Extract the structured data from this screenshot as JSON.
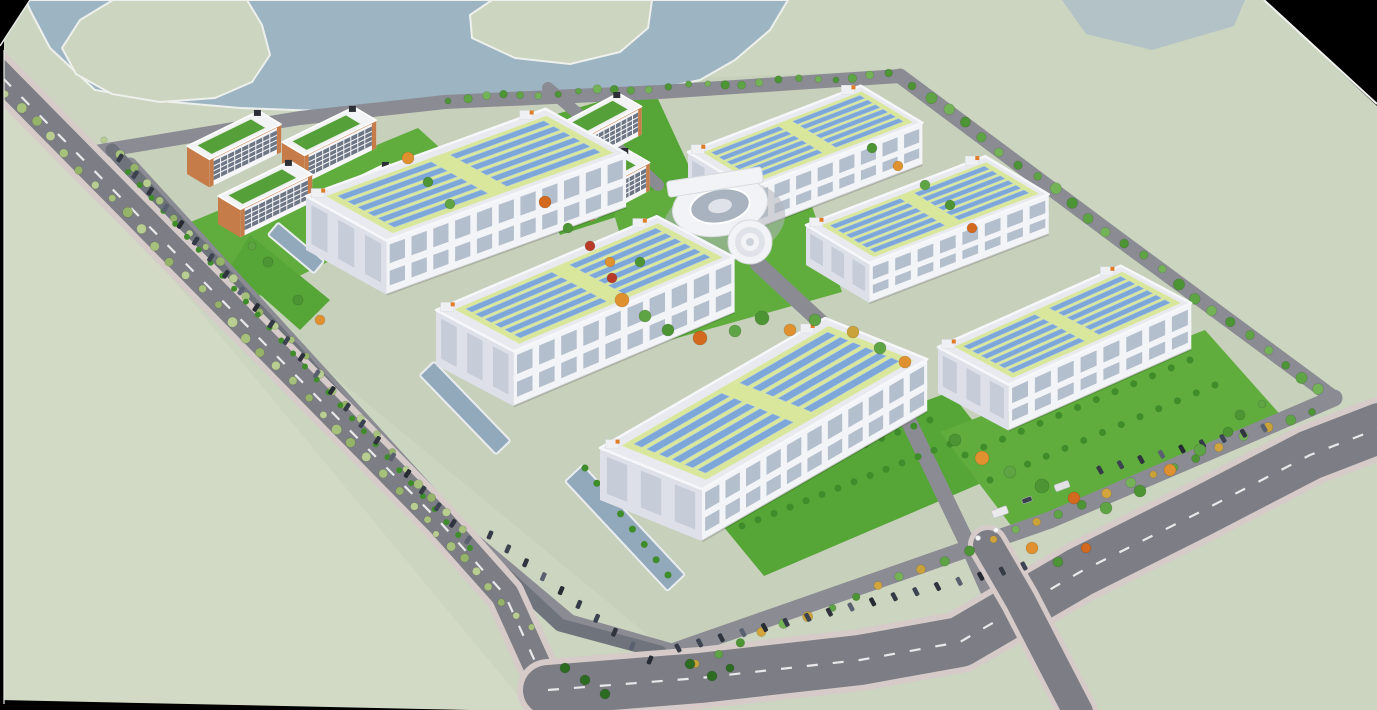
{
  "meta": {
    "description": "Aerial 3D architectural rendering of an industrial campus with solar-roof factory halls, office blocks, a circular admin building, lakes, tree-lined roads and parking",
    "width": 1377,
    "height": 710
  },
  "palette": {
    "void": "#000000",
    "terrain": "#cbd5c0",
    "lowland": "#d2dac6",
    "campus": "#c6d0ba",
    "water": "#9db4c2",
    "waterPocket": "#afc0c6",
    "shoreLine": "#edf0ec",
    "roadOuter": "#7d7d85",
    "roadInner": "#8b8b93",
    "sidewalk": "#d6cbc9",
    "dash": "#e9e9ec",
    "parking": "#6e737c",
    "lawn1": "#60ad3d",
    "lawn2": "#56a537",
    "hedge": "#3f8c2a",
    "pond": "#92a9bb",
    "pondRim": "#e9edf0",
    "factoryFront": "#f3f4f7",
    "factorySide": "#dde0e8",
    "factoryRoof": "#e8eaef",
    "roofRim": "#f6f7fa",
    "roofLime": "#d9e79c",
    "solarPanel": "#7da7d9",
    "solarRim": "#adc8e8",
    "windowBand": "#b4bfcd",
    "vent": "#eef0f3",
    "accentOrange": "#e07b28",
    "officeWall": "#f6f6f8",
    "officeTrim": "#c67c49",
    "officeWindow": "#6d7684",
    "officeRoof": "#f2f3f5",
    "officeRoofGreen": "#55a039",
    "darkUnit": "#2c3036",
    "circWhite": "#f2f3f6",
    "circMid": "#dfe3e9",
    "circCourt": "#a9b3bf",
    "circLine": "#d6dade",
    "plaza": "#b2b7be",
    "treePale": [
      "#b7cd92",
      "#a6c17c",
      "#95b469"
    ],
    "treeGreen": [
      "#4c9434",
      "#5ea344",
      "#74b258"
    ],
    "treeMixGold": [
      "#4c9434",
      "#5ea344",
      "#c9a23a",
      "#74b258",
      "#d2a43c"
    ],
    "clusterColors": {
      "or": "#e0912f",
      "o2": "#d2691e",
      "rd": "#b83a28",
      "gd": "#c9a23a",
      "g1": "#4c9434",
      "g2": "#5ea344",
      "g3": "#3b7f2b",
      "pn": "#2e6b22"
    },
    "carColors": [
      "#343b47",
      "#3d4451",
      "#2f343e",
      "#596070",
      "#272b33"
    ]
  },
  "terrain": {
    "lowlandPoly": [
      [
        0,
        70
      ],
      [
        530,
        710
      ],
      [
        0,
        710
      ]
    ],
    "campusPoly": [
      [
        70,
        158
      ],
      [
        440,
        88
      ],
      [
        900,
        70
      ],
      [
        1335,
        398
      ],
      [
        672,
        655
      ]
    ]
  },
  "water": {
    "main": [
      [
        26,
        0
      ],
      [
        788,
        0
      ],
      [
        770,
        30
      ],
      [
        735,
        60
      ],
      [
        700,
        80
      ],
      [
        662,
        88
      ],
      [
        560,
        93
      ],
      [
        445,
        97
      ],
      [
        390,
        104
      ],
      [
        320,
        111
      ],
      [
        240,
        108
      ],
      [
        160,
        101
      ],
      [
        95,
        90
      ],
      [
        50,
        48
      ],
      [
        30,
        10
      ]
    ],
    "islands": [
      [
        [
          113,
          0
        ],
        [
          247,
          0
        ],
        [
          262,
          25
        ],
        [
          270,
          55
        ],
        [
          252,
          82
        ],
        [
          215,
          98
        ],
        [
          160,
          102
        ],
        [
          112,
          94
        ],
        [
          76,
          74
        ],
        [
          62,
          48
        ],
        [
          80,
          20
        ]
      ],
      [
        [
          492,
          0
        ],
        [
          652,
          0
        ],
        [
          648,
          28
        ],
        [
          620,
          52
        ],
        [
          570,
          64
        ],
        [
          515,
          58
        ],
        [
          472,
          38
        ],
        [
          470,
          15
        ]
      ]
    ],
    "pocket": [
      [
        1062,
        0
      ],
      [
        1245,
        0
      ],
      [
        1234,
        26
      ],
      [
        1152,
        50
      ],
      [
        1086,
        34
      ]
    ]
  },
  "roads": {
    "outerLeft": {
      "pts": [
        [
          -15,
          60
        ],
        [
          200,
          278
        ],
        [
          440,
          522
        ],
        [
          505,
          595
        ],
        [
          548,
          690
        ]
      ],
      "w": 28,
      "sidewalk": 40,
      "dash": true
    },
    "bottom": {
      "pts": [
        [
          548,
          690
        ],
        [
          700,
          678
        ],
        [
          860,
          660
        ],
        [
          960,
          642
        ],
        [
          1080,
          572
        ],
        [
          1200,
          512
        ],
        [
          1310,
          455
        ],
        [
          1380,
          428
        ]
      ],
      "w": 50,
      "sidewalk": 62,
      "dash": true
    },
    "branch": {
      "pts": [
        [
          988,
          545
        ],
        [
          1020,
          600
        ],
        [
          1052,
          662
        ],
        [
          1078,
          712
        ]
      ],
      "w": 30,
      "sidewalk": 40,
      "dash": false
    },
    "internal": [
      {
        "pts": [
          [
            95,
            152
          ],
          [
            300,
            118
          ],
          [
            445,
            102
          ],
          [
            660,
            92
          ],
          [
            900,
            76
          ]
        ],
        "w": 14
      },
      {
        "pts": [
          [
            900,
            76
          ],
          [
            1120,
            240
          ],
          [
            1334,
            398
          ]
        ],
        "w": 15
      },
      {
        "pts": [
          [
            1334,
            398
          ],
          [
            1050,
            520
          ],
          [
            672,
            652
          ]
        ],
        "w": 17
      },
      {
        "pts": [
          [
            130,
            165
          ],
          [
            470,
            538
          ],
          [
            570,
            622
          ],
          [
            668,
            650
          ]
        ],
        "w": 15
      },
      {
        "pts": [
          [
            548,
            88
          ],
          [
            620,
            150
          ],
          [
            658,
            185
          ]
        ],
        "w": 12
      },
      {
        "pts": [
          [
            758,
            264
          ],
          [
            838,
            338
          ],
          [
            908,
            420
          ],
          [
            968,
            545
          ],
          [
            988,
            590
          ]
        ],
        "w": 16
      }
    ],
    "parkingStrip": {
      "pts": [
        [
          112,
          150
        ],
        [
          460,
          532
        ],
        [
          560,
          625
        ],
        [
          660,
          652
        ]
      ],
      "w": 13
    }
  },
  "lawns": [
    {
      "pts": [
        [
          152,
          238
        ],
        [
          418,
          128
        ],
        [
          482,
          186
        ],
        [
          214,
          318
        ]
      ],
      "c": "lawn1"
    },
    {
      "pts": [
        [
          516,
          126
        ],
        [
          652,
          86
        ],
        [
          700,
          190
        ],
        [
          560,
          235
        ]
      ],
      "c": "lawn2"
    },
    {
      "pts": [
        [
          610,
          200
        ],
        [
          795,
          158
        ],
        [
          842,
          292
        ],
        [
          652,
          345
        ]
      ],
      "c": "lawn1"
    },
    {
      "pts": [
        [
          690,
          486
        ],
        [
          950,
          392
        ],
        [
          1012,
          470
        ],
        [
          764,
          576
        ]
      ],
      "c": "lawn2"
    },
    {
      "pts": [
        [
          940,
          432
        ],
        [
          1205,
          330
        ],
        [
          1285,
          420
        ],
        [
          1016,
          532
        ]
      ],
      "c": "lawn1"
    },
    {
      "pts": [
        [
          650,
          652
        ],
        [
          742,
          656
        ],
        [
          736,
          698
        ],
        [
          658,
          696
        ]
      ],
      "c": "lawn2"
    },
    {
      "pts": [
        [
          250,
          235
        ],
        [
          330,
          300
        ],
        [
          300,
          330
        ],
        [
          230,
          268
        ]
      ],
      "c": "lawn2"
    }
  ],
  "ponds": [
    {
      "cx": 296,
      "cy": 248,
      "len": 60,
      "wid": 16,
      "ang": 40
    },
    {
      "cx": 465,
      "cy": 408,
      "len": 110,
      "wid": 20,
      "ang": 46
    },
    {
      "cx": 625,
      "cy": 528,
      "len": 150,
      "wid": 24,
      "ang": 47
    }
  ],
  "treeRows": [
    {
      "a": [
        5,
        92
      ],
      "b": [
        428,
        520
      ],
      "n": 29,
      "r": 4.5,
      "pal": "treePale"
    },
    {
      "a": [
        104,
        138
      ],
      "b": [
        462,
        530
      ],
      "n": 26,
      "r": 4,
      "pal": "treePale"
    },
    {
      "a": [
        436,
        532
      ],
      "b": [
        530,
        628
      ],
      "n": 8,
      "r": 4,
      "pal": "treePale"
    },
    {
      "a": [
        448,
        99
      ],
      "b": [
        890,
        75
      ],
      "n": 25,
      "r": 3.8,
      "pal": "treeGreen"
    },
    {
      "a": [
        912,
        84
      ],
      "b": [
        1320,
        390
      ],
      "n": 24,
      "r": 5,
      "pal": "treeGreen"
    },
    {
      "a": [
        1312,
        410
      ],
      "b": [
        694,
        662
      ],
      "n": 28,
      "r": 4.5,
      "pal": "treeMixGold"
    }
  ],
  "hedgeRows": [
    {
      "a": [
        128,
        172
      ],
      "b": [
        470,
        548
      ],
      "n": 30,
      "r": 3
    },
    {
      "a": [
        585,
        468
      ],
      "b": [
        668,
        575
      ],
      "n": 8,
      "r": 3.5
    },
    {
      "a": [
        720,
        500
      ],
      "b": [
        930,
        420
      ],
      "n": 14,
      "r": 3.5
    },
    {
      "a": [
        742,
        526
      ],
      "b": [
        950,
        444
      ],
      "n": 14,
      "r": 3.5
    },
    {
      "a": [
        965,
        455
      ],
      "b": [
        1190,
        360
      ],
      "n": 13,
      "r": 3.5
    },
    {
      "a": [
        990,
        480
      ],
      "b": [
        1215,
        385
      ],
      "n": 13,
      "r": 3.5
    }
  ],
  "treeClusters": [
    [
      622,
      300,
      7,
      "or"
    ],
    [
      645,
      316,
      6,
      "g2"
    ],
    [
      668,
      330,
      6,
      "g1"
    ],
    [
      700,
      338,
      7,
      "o2"
    ],
    [
      735,
      331,
      6,
      "g2"
    ],
    [
      762,
      318,
      7,
      "g1"
    ],
    [
      790,
      330,
      6,
      "or"
    ],
    [
      815,
      320,
      6,
      "g2"
    ],
    [
      640,
      262,
      5,
      "g1"
    ],
    [
      612,
      278,
      5,
      "rd"
    ],
    [
      955,
      440,
      6,
      "g1"
    ],
    [
      982,
      458,
      7,
      "or"
    ],
    [
      1010,
      472,
      6,
      "g2"
    ],
    [
      1042,
      486,
      7,
      "g1"
    ],
    [
      1074,
      498,
      6,
      "o2"
    ],
    [
      1106,
      508,
      6,
      "g2"
    ],
    [
      1140,
      491,
      6,
      "g1"
    ],
    [
      1170,
      470,
      6,
      "or"
    ],
    [
      1200,
      450,
      6,
      "g2"
    ],
    [
      1228,
      432,
      5,
      "g1"
    ],
    [
      408,
      158,
      6,
      "or"
    ],
    [
      428,
      182,
      5,
      "g1"
    ],
    [
      450,
      204,
      5,
      "g2"
    ],
    [
      545,
      202,
      6,
      "o2"
    ],
    [
      568,
      228,
      5,
      "g1"
    ],
    [
      590,
      246,
      5,
      "rd"
    ],
    [
      610,
      262,
      5,
      "or"
    ],
    [
      872,
      148,
      5,
      "g1"
    ],
    [
      898,
      166,
      5,
      "or"
    ],
    [
      925,
      185,
      5,
      "g2"
    ],
    [
      950,
      205,
      5,
      "g1"
    ],
    [
      972,
      228,
      5,
      "o2"
    ],
    [
      1032,
      548,
      6,
      "or"
    ],
    [
      1058,
      562,
      5,
      "g1"
    ],
    [
      1086,
      548,
      5,
      "o2"
    ],
    [
      268,
      262,
      5,
      "g1"
    ],
    [
      252,
      246,
      4,
      "g2"
    ],
    [
      298,
      300,
      5,
      "g1"
    ],
    [
      320,
      320,
      5,
      "or"
    ],
    [
      565,
      668,
      5,
      "pn"
    ],
    [
      585,
      680,
      5,
      "pn"
    ],
    [
      605,
      694,
      5,
      "pn"
    ],
    [
      690,
      664,
      5,
      "pn"
    ],
    [
      712,
      676,
      5,
      "pn"
    ],
    [
      730,
      668,
      4,
      "pn"
    ],
    [
      853,
      332,
      6,
      "gd"
    ],
    [
      880,
      348,
      6,
      "g2"
    ],
    [
      905,
      362,
      6,
      "or"
    ],
    [
      1240,
      415,
      5,
      "g1"
    ],
    [
      1262,
      404,
      4,
      "g2"
    ]
  ],
  "carRows": [
    {
      "a": [
        120,
        158
      ],
      "b": [
        468,
        540
      ],
      "n": 24
    },
    {
      "a": [
        490,
        535
      ],
      "b": [
        650,
        660
      ],
      "n": 10
    },
    {
      "a": [
        678,
        648
      ],
      "b": [
        1024,
        566
      ],
      "n": 17
    },
    {
      "a": [
        1100,
        470
      ],
      "b": [
        1264,
        428
      ],
      "n": 9
    }
  ],
  "vehicles": [
    {
      "x": 1000,
      "y": 512,
      "w": 16,
      "h": 8,
      "rot": -20,
      "c": "#eaeaed"
    },
    {
      "x": 1062,
      "y": 486,
      "w": 15,
      "h": 7,
      "rot": -20,
      "c": "#e2e2e6"
    },
    {
      "x": 1027,
      "y": 500,
      "w": 10,
      "h": 5,
      "rot": -20,
      "c": "#3a404c"
    }
  ],
  "gatePosts": [
    [
      978,
      538
    ],
    [
      996,
      530
    ]
  ],
  "factories": [
    {
      "id": "factory-1",
      "x": 688,
      "y": 152,
      "len": 185,
      "wid": 72,
      "h": 42,
      "au": -21,
      "av": 31
    },
    {
      "id": "factory-2",
      "x": 806,
      "y": 225,
      "len": 192,
      "wid": 74,
      "h": 40,
      "au": -21,
      "av": 31
    },
    {
      "id": "factory-3",
      "x": 938,
      "y": 347,
      "len": 200,
      "wid": 80,
      "h": 46,
      "au": -24,
      "av": 28
    },
    {
      "id": "factory-4",
      "x": 306,
      "y": 196,
      "len": 255,
      "wid": 92,
      "h": 54,
      "au": -20,
      "av": 29
    },
    {
      "id": "factory-5",
      "x": 436,
      "y": 310,
      "len": 240,
      "wid": 88,
      "h": 55,
      "au": -23,
      "av": 28
    },
    {
      "id": "factory-6",
      "x": 600,
      "y": 448,
      "len": 260,
      "wid": 110,
      "h": 52,
      "au": -30,
      "av": 22
    }
  ],
  "offices": [
    {
      "id": "office-1",
      "x": 187,
      "y": 146,
      "len": 80,
      "wid": 26,
      "h": 28,
      "au": -26,
      "av": 31
    },
    {
      "id": "office-2",
      "x": 282,
      "y": 142,
      "len": 80,
      "wid": 26,
      "h": 28,
      "au": -26,
      "av": 31
    },
    {
      "id": "office-3",
      "x": 218,
      "y": 196,
      "len": 80,
      "wid": 26,
      "h": 28,
      "au": -26,
      "av": 31
    },
    {
      "id": "office-4",
      "x": 315,
      "y": 198,
      "len": 80,
      "wid": 26,
      "h": 28,
      "au": -26,
      "av": 31
    },
    {
      "id": "office-5",
      "x": 560,
      "y": 124,
      "len": 66,
      "wid": 27,
      "h": 28,
      "au": -28,
      "av": 30
    },
    {
      "id": "office-6",
      "x": 568,
      "y": 180,
      "len": 66,
      "wid": 27,
      "h": 28,
      "au": -28,
      "av": 30
    }
  ],
  "circular": {
    "plaza": {
      "cx": 724,
      "cy": 222,
      "rx": 62,
      "ry": 40,
      "rot": -12
    },
    "ring": {
      "cx": 720,
      "cy": 206,
      "rx": 48,
      "ry": 30,
      "rot": -10
    },
    "court": {
      "rx": 30,
      "ry": 17
    },
    "bar": {
      "cx": 715,
      "cy": 182,
      "w": 96,
      "h": 16,
      "rot": -9
    },
    "stem": [
      [
        730,
        222
      ],
      [
        746,
        216
      ],
      [
        754,
        234
      ],
      [
        738,
        240
      ]
    ],
    "tower": {
      "cx": 750,
      "cy": 242,
      "r": [
        22,
        15,
        9,
        4
      ]
    }
  },
  "edges": {
    "cornerTL": [
      [
        0,
        0
      ],
      [
        30,
        0
      ],
      [
        0,
        46
      ]
    ],
    "cornerTR": [
      [
        1264,
        0
      ],
      [
        1377,
        0
      ],
      [
        1377,
        106
      ]
    ],
    "leftStrip": [
      0,
      40,
      4,
      670
    ],
    "bottomSliver": [
      [
        0,
        700
      ],
      [
        470,
        710
      ],
      [
        0,
        710
      ]
    ],
    "whiteTR": [
      [
        1264,
        0
      ],
      [
        1377,
        104
      ]
    ],
    "whiteTL": [
      [
        30,
        0
      ],
      [
        0,
        46
      ]
    ],
    "whiteLeft": [
      [
        4,
        50
      ],
      [
        4,
        704
      ]
    ]
  }
}
